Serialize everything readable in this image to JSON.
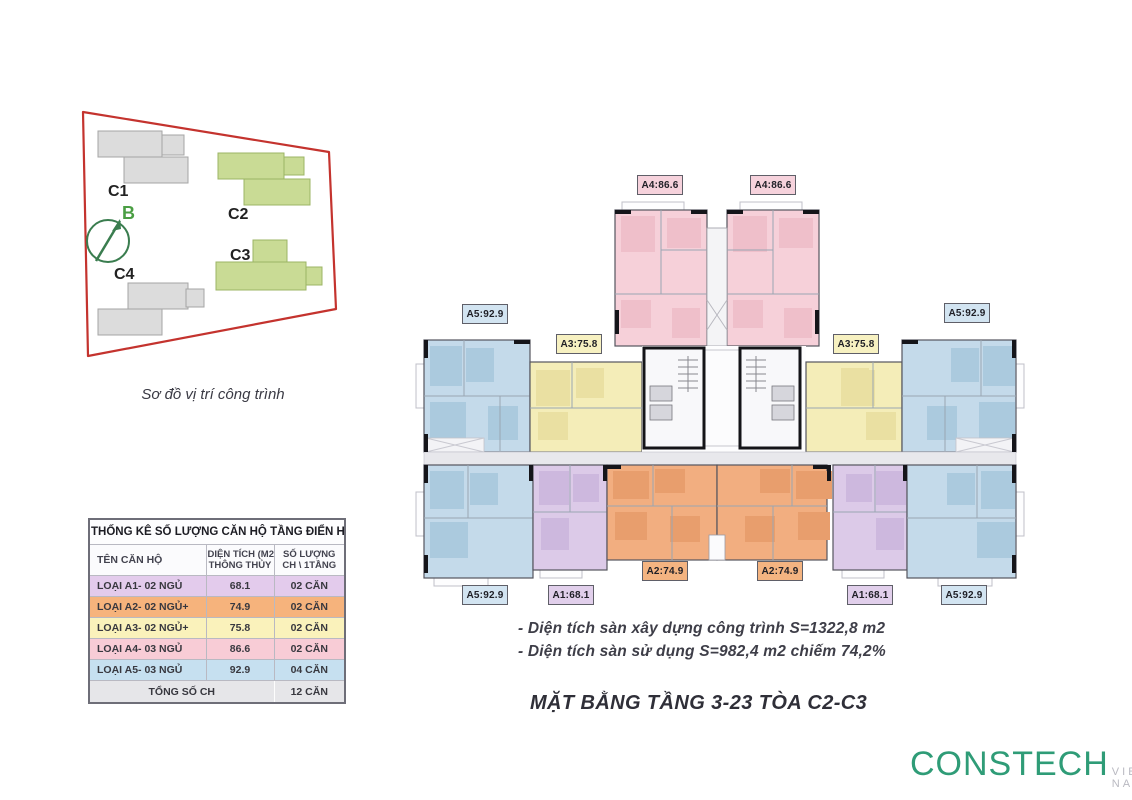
{
  "site_map": {
    "caption": "Sơ đồ vị trí công trình",
    "compass_label": "B",
    "buildings": [
      {
        "label": "C1",
        "type": "other"
      },
      {
        "label": "C2",
        "type": "highlight"
      },
      {
        "label": "C3",
        "type": "highlight"
      },
      {
        "label": "C4",
        "type": "other"
      }
    ],
    "colors": {
      "boundary": "#c4332e",
      "highlight": "#c9db95",
      "other": "#dcdcdc",
      "compass": "#3a7d4f",
      "compass_label": "#4a9e43"
    }
  },
  "stats_table": {
    "title": "THỐNG KÊ SỐ LƯỢNG CĂN HỘ TẦNG ĐIỂN HÌNH C2-C3",
    "header": {
      "col1": "TÊN CĂN HỘ",
      "col2_line1": "DIỆN TÍCH (M2)",
      "col2_line2": "THÔNG THỦY",
      "col3_line1": "SỐ LƯỢNG",
      "col3_line2": "CH \\ 1TẦNG"
    },
    "rows": [
      {
        "name": "LOẠI A1- 02 NGỦ",
        "area": "68.1",
        "count": "02 CĂN",
        "color": "#e3cbec"
      },
      {
        "name": "LOẠI A2- 02 NGỦ+",
        "area": "74.9",
        "count": "02 CĂN",
        "color": "#f6b37c"
      },
      {
        "name": "LOẠI A3- 02 NGỦ+",
        "area": "75.8",
        "count": "02 CĂN",
        "color": "#faf2bb"
      },
      {
        "name": "LOẠI A4- 03 NGỦ",
        "area": "86.6",
        "count": "02 CĂN",
        "color": "#f8ccd6"
      },
      {
        "name": "LOẠI A5- 03 NGỦ",
        "area": "92.9",
        "count": "04 CĂN",
        "color": "#c6e0f0"
      }
    ],
    "total": {
      "label": "TỔNG SỐ CH",
      "count": "12 CĂN",
      "color": "#e6e6e9"
    }
  },
  "floor_plan": {
    "labels": [
      {
        "id": "a4-left",
        "unit": "A4",
        "text": "A4:86.6"
      },
      {
        "id": "a4-right",
        "unit": "A4",
        "text": "A4:86.6"
      },
      {
        "id": "a5-top-left",
        "unit": "A5",
        "text": "A5:92.9"
      },
      {
        "id": "a3-left",
        "unit": "A3",
        "text": "A3:75.8"
      },
      {
        "id": "a3-right",
        "unit": "A3",
        "text": "A3:75.8"
      },
      {
        "id": "a5-top-right",
        "unit": "A5",
        "text": "A5:92.9"
      },
      {
        "id": "a2-left",
        "unit": "A2",
        "text": "A2:74.9"
      },
      {
        "id": "a2-right",
        "unit": "A2",
        "text": "A2:74.9"
      },
      {
        "id": "a5-bottom-left",
        "unit": "A5",
        "text": "A5:92.9"
      },
      {
        "id": "a1-bottom-left",
        "unit": "A1",
        "text": "A1:68.1"
      },
      {
        "id": "a1-bottom-right",
        "unit": "A1",
        "text": "A1:68.1"
      },
      {
        "id": "a5-bottom-right",
        "unit": "A5",
        "text": "A5:92.9"
      }
    ],
    "unit_colors": {
      "A1": "#dccae8",
      "A2": "#f2ae80",
      "A3": "#f4edb8",
      "A4": "#f6d0d9",
      "A5": "#c4daea"
    },
    "notes": [
      "- Diện tích sàn xây dựng công trình S=1322,8 m2",
      "- Diện tích sàn sử dụng S=982,4 m2 chiếm 74,2%"
    ],
    "title": "MẶT BẰNG TẦNG 3-23 TÒA C2-C3"
  },
  "logo": {
    "text": "CONSTECH",
    "suffix": "VIET NAM",
    "color": "#2f9c77"
  }
}
